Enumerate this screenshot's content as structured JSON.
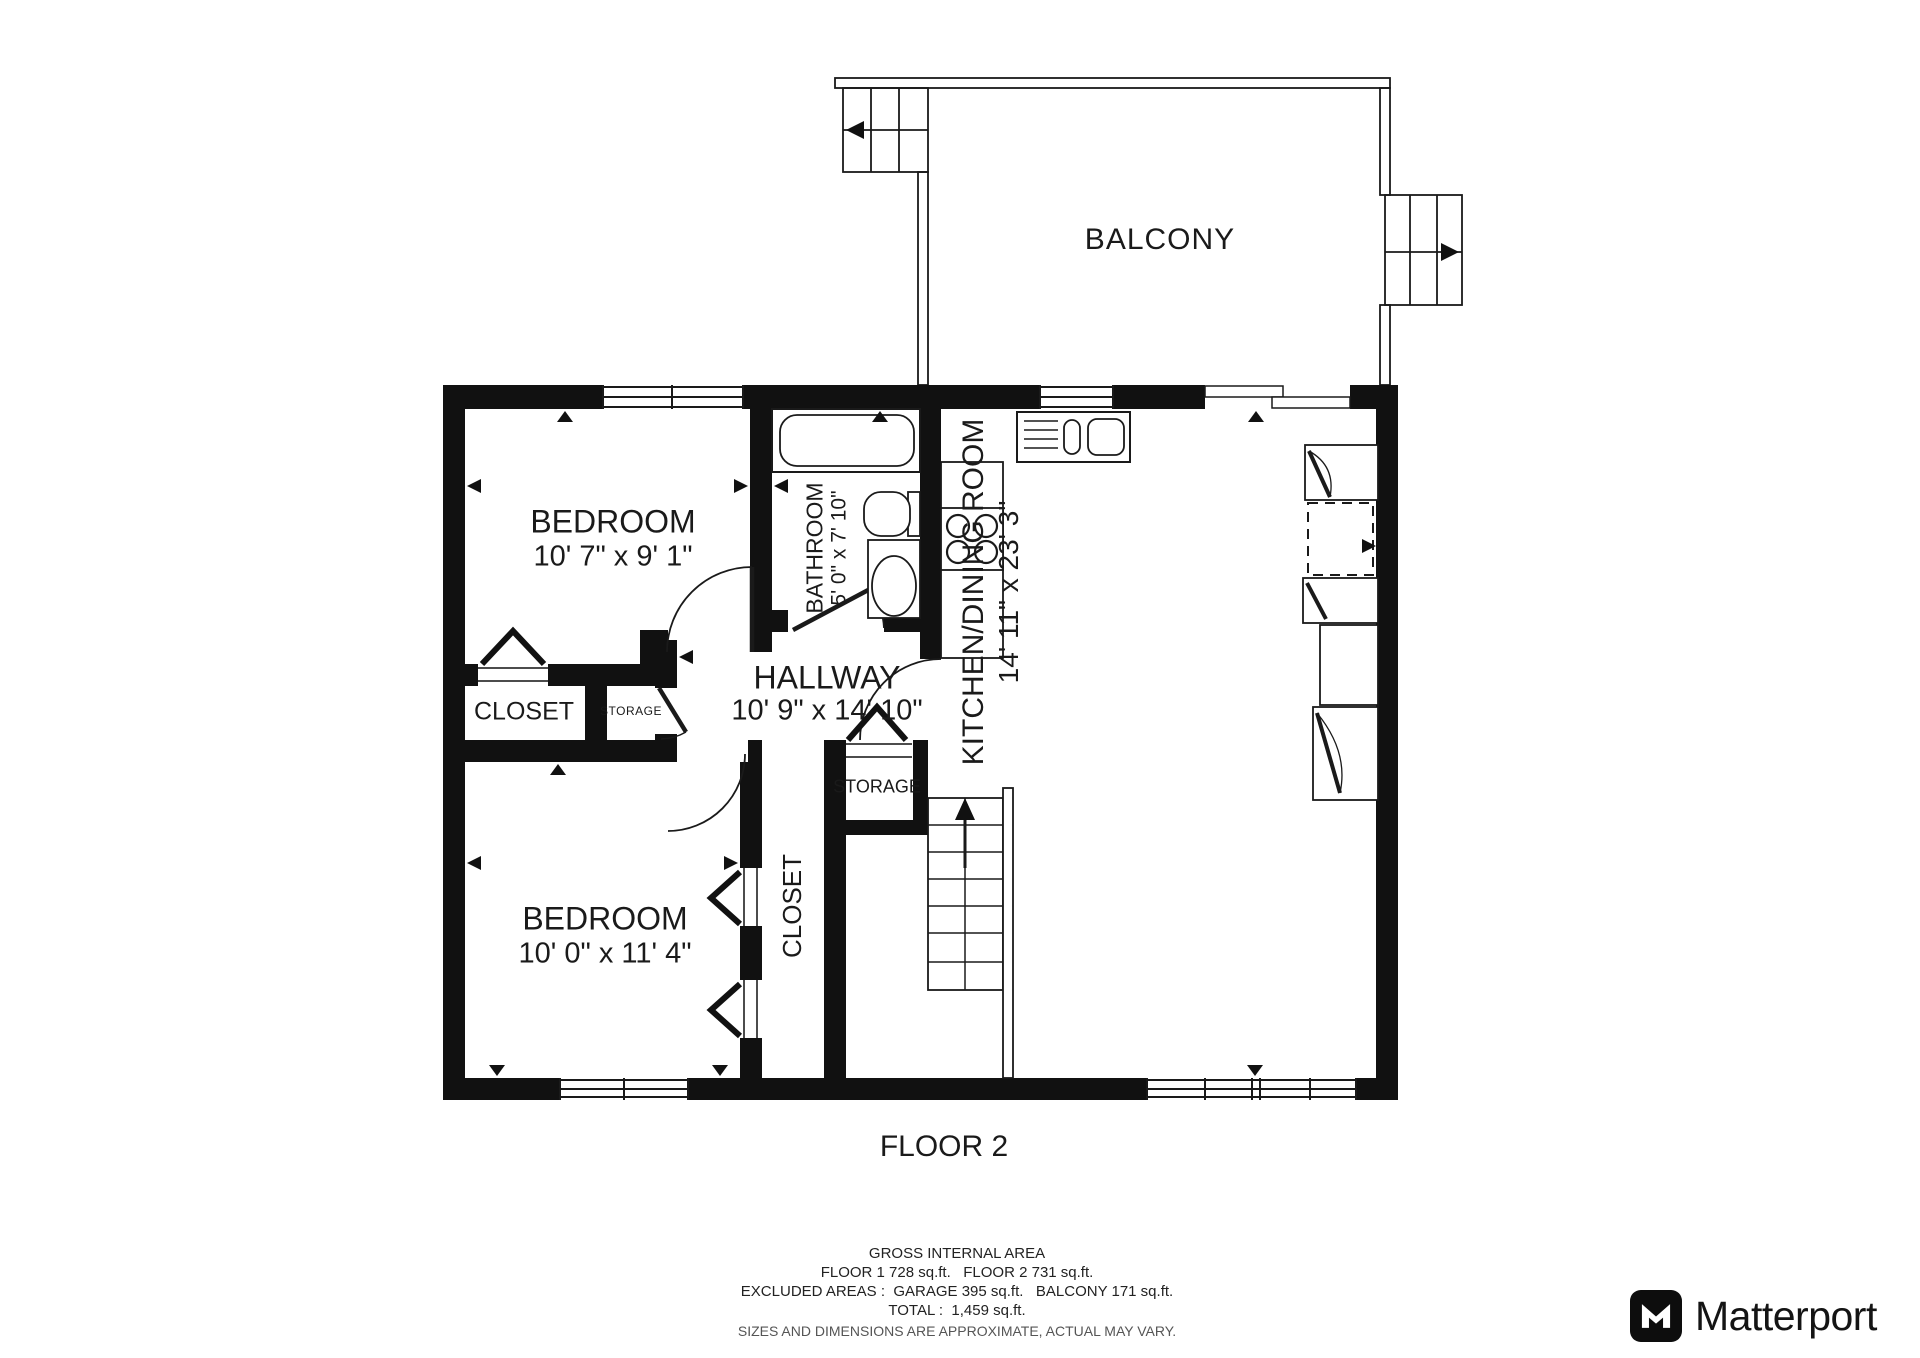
{
  "floor_plan": {
    "floor_label": "FLOOR 2",
    "rooms": {
      "balcony": {
        "name": "BALCONY"
      },
      "bedroom_top": {
        "name": "BEDROOM",
        "dimensions": "10' 7\" x 9' 1\""
      },
      "bathroom": {
        "name": "BATHROOM",
        "dimensions": "5' 0\" x 7' 10\""
      },
      "hallway": {
        "name": "HALLWAY",
        "dimensions": "10' 9\" x 14' 10\""
      },
      "kitchen_dining": {
        "name": "KITCHEN/DINING ROOM",
        "dimensions": "14' 11\" x 23' 3\""
      },
      "closet_upper": {
        "name": "CLOSET"
      },
      "storage_upper": {
        "name": "STORAGE"
      },
      "storage_lower": {
        "name": "STORAGE"
      },
      "closet_lower": {
        "name": "CLOSET"
      },
      "bedroom_bottom": {
        "name": "BEDROOM",
        "dimensions": "10' 0\" x 11' 4\""
      }
    }
  },
  "footer": {
    "title": "GROSS INTERNAL AREA",
    "floors": "FLOOR 1 728 sq.ft.   FLOOR 2 731 sq.ft.",
    "excluded": "EXCLUDED AREAS :  GARAGE 395 sq.ft.   BALCONY 171 sq.ft.",
    "total": "TOTAL :  1,459 sq.ft.",
    "disclaimer": "SIZES AND DIMENSIONS ARE APPROXIMATE, ACTUAL MAY VARY."
  },
  "branding": {
    "logo_text": "Matterport"
  },
  "colors": {
    "wall": "#111111",
    "line": "#1a1a1a",
    "text": "#1a1a1a",
    "muted_text": "#555555"
  }
}
